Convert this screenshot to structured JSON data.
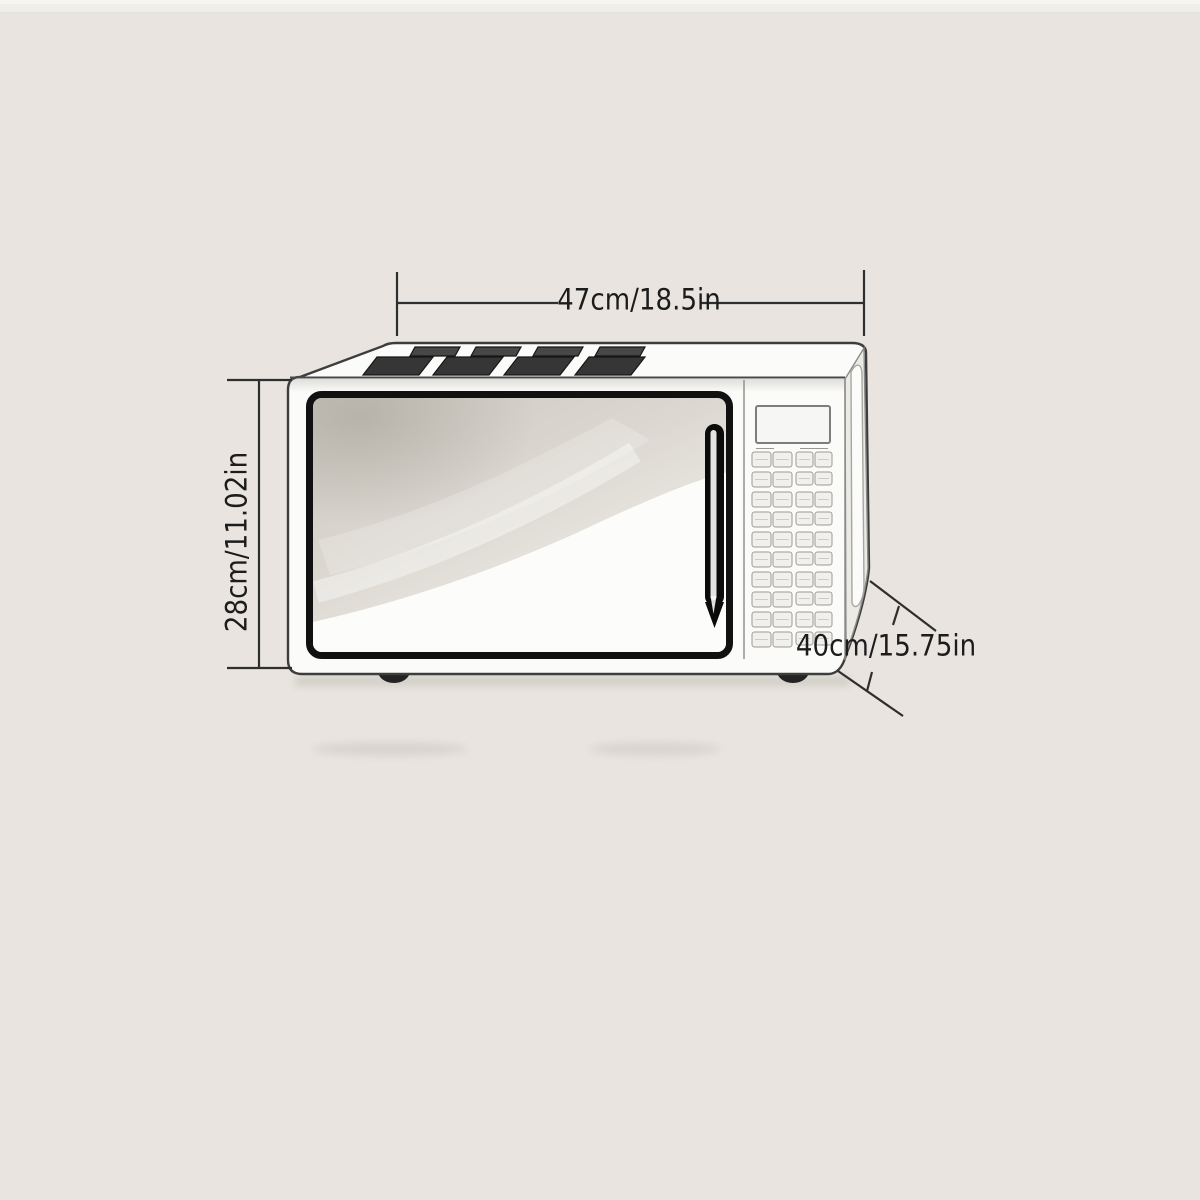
{
  "illustration": {
    "name": "microwave-oven-outline-drawing"
  },
  "colors": {
    "background": "#e9e4df",
    "dimension_line": "#2e2e2e",
    "label_text": "#1c1c1c",
    "body_white": "#fbfbf9",
    "vent_dark": "#383838",
    "door_frame": "#111111",
    "glass_gray": "#d0ccc4",
    "glass_highlight": "#fcfcfb",
    "handle_black": "#0b0b0b"
  },
  "dimension_labels": {
    "width": "47cm/18.5in",
    "height": "28cm/11.02in",
    "depth": "40cm/15.75in"
  }
}
